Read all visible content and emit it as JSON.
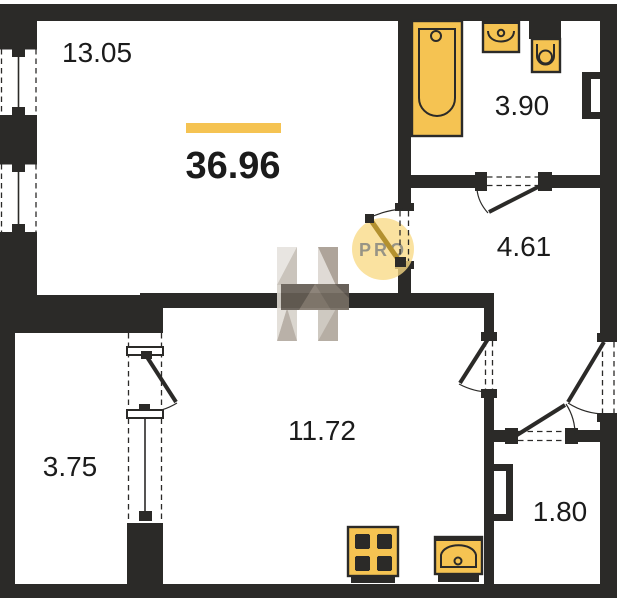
{
  "plan": {
    "type_label": "apartment-floor-plan",
    "total_area_label": "36.96",
    "rooms": [
      {
        "id": "living-room",
        "area_label": "13.05"
      },
      {
        "id": "bathroom",
        "area_label": "3.90"
      },
      {
        "id": "hallway",
        "area_label": "4.61"
      },
      {
        "id": "kitchen-living",
        "area_label": "11.72"
      },
      {
        "id": "balcony",
        "area_label": "3.75"
      },
      {
        "id": "storage",
        "area_label": "1.80"
      }
    ],
    "watermark": {
      "badge_text": "PRO",
      "logo": "h-faceted-logo"
    },
    "fixtures": [
      "bathtub",
      "wash-basin",
      "toilet",
      "stove",
      "kitchen-sink"
    ],
    "colors": {
      "wall": "#2B2A28",
      "accent": "#F5C352",
      "accent-soft": "#F8DA85",
      "gold": "#B3912F",
      "watermark-text": "#8D8C83",
      "ink": "#1B1B1B",
      "paper": "#FFFFFF"
    }
  }
}
